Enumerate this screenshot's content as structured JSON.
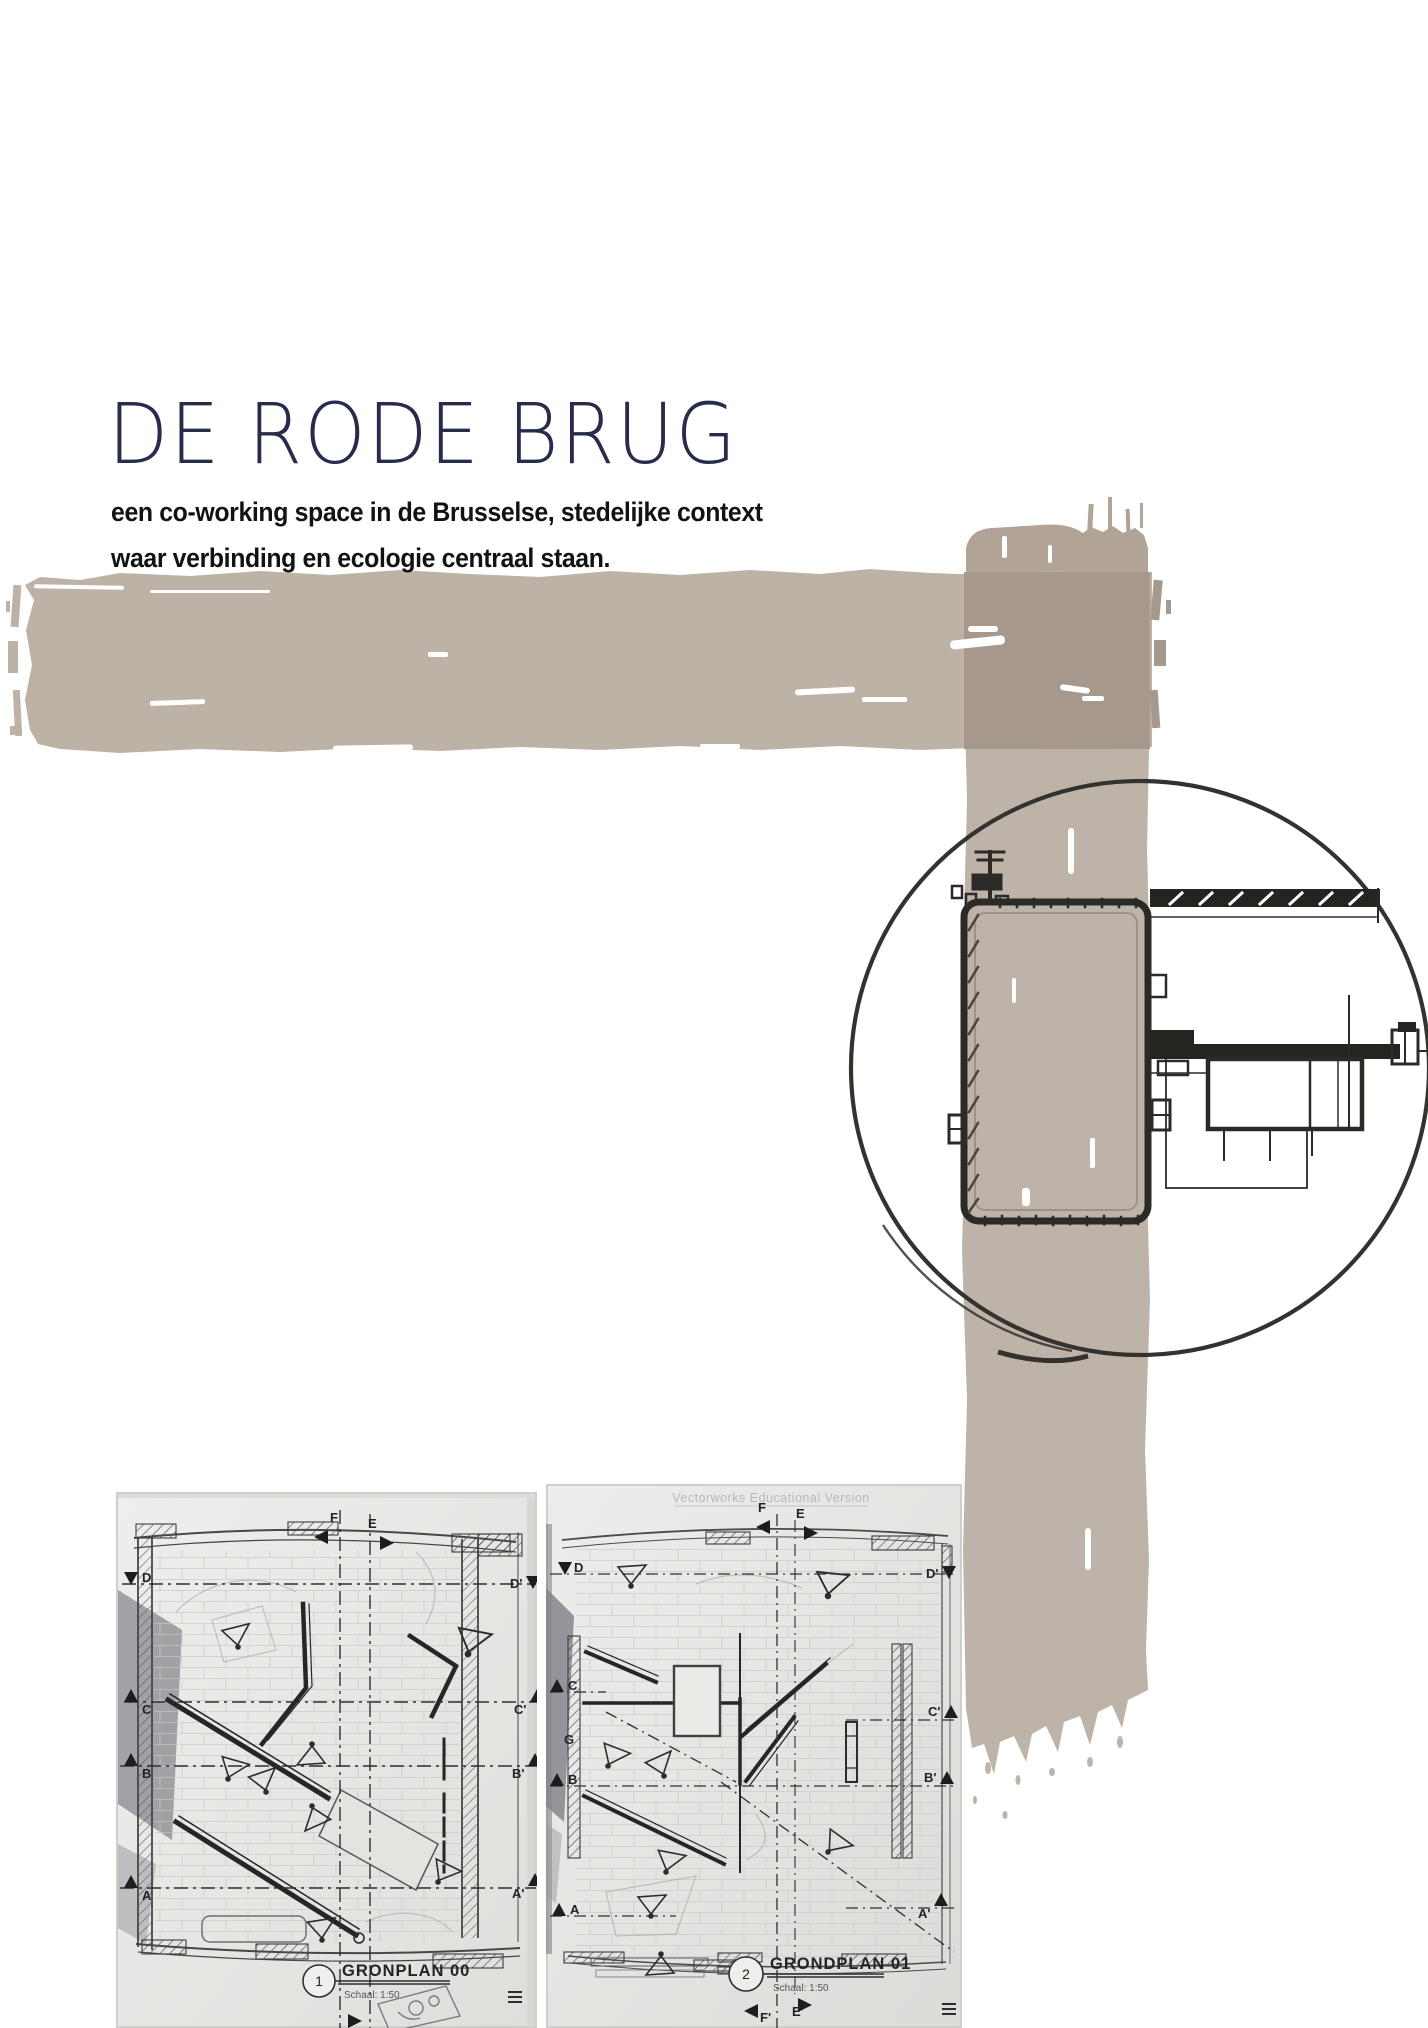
{
  "header": {
    "title": "DE RODE BRUG",
    "subtitle_line1": "een co-working space in de Brusselse, stedelijke context",
    "subtitle_line2": "waar verbinding en ecologie centraal staan."
  },
  "colors": {
    "title_navy": "#272c4c",
    "brush_taupe": "#bdb2a6",
    "brush_taupe_vertical": "#beb3a8",
    "brush_overlap": "#a6988c",
    "ink": "#2b2a26",
    "scan_paper": "#e9e8e5"
  },
  "plans": [
    {
      "number": "1",
      "label": "GRONPLAN 00",
      "scale": "Schaal: 1:50",
      "markers_top": [
        "F",
        "E"
      ],
      "markers_left": [
        "D",
        "C",
        "B",
        "A"
      ],
      "markers_right": [
        "D'",
        "C'",
        "B'",
        "A'"
      ]
    },
    {
      "number": "2",
      "label": "GRONDPLAN 01",
      "scale": "Schaal: 1:50",
      "watermark": "Vectorworks Educational Version",
      "markers_top": [
        "F",
        "E"
      ],
      "markers_left": [
        "D",
        "C",
        "G",
        "B",
        "A"
      ],
      "markers_right": [
        "D'",
        "C'",
        "B'",
        "A'"
      ],
      "markers_bottom": [
        "F'",
        "E'"
      ]
    }
  ]
}
